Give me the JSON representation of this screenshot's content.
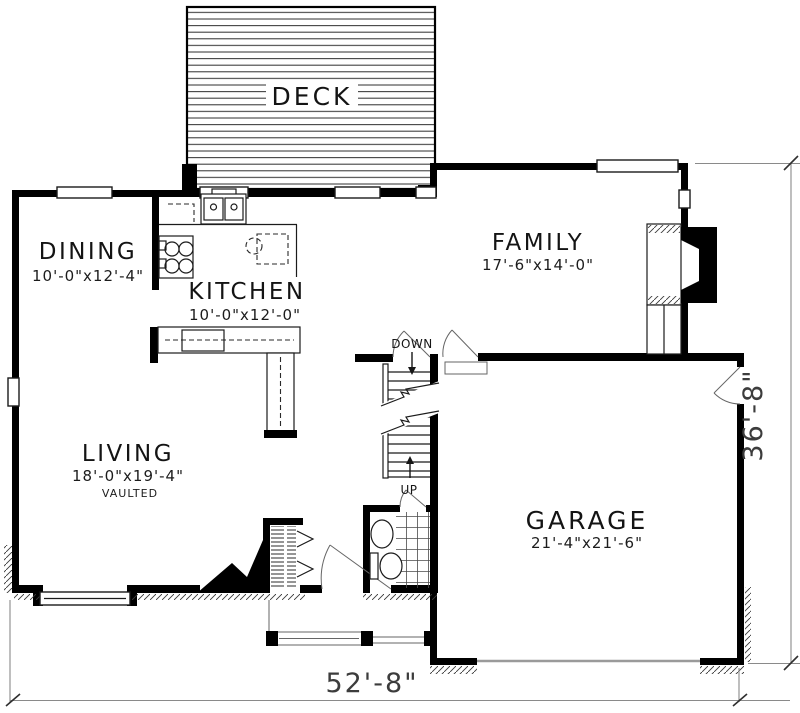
{
  "plan": {
    "rooms": {
      "deck": {
        "name": "DECK"
      },
      "dining": {
        "name": "DINING",
        "dims": "10'-0\"x12'-4\""
      },
      "kitchen": {
        "name": "KITCHEN",
        "dims": "10'-0\"x12'-0\""
      },
      "family": {
        "name": "FAMILY",
        "dims": "17'-6\"x14'-0\""
      },
      "living": {
        "name": "LIVING",
        "dims": "18'-0\"x19'-4\"",
        "note": "VAULTED"
      },
      "garage": {
        "name": "GARAGE",
        "dims": "21'-4\"x21'-6\""
      }
    },
    "stairs": {
      "down_label": "DOWN",
      "up_label": "UP"
    },
    "dimensions": {
      "overall_width": "52'-8\"",
      "overall_depth": "36'-8\""
    },
    "colors": {
      "wall": "#000000",
      "thin_line": "#1b1b1b",
      "dimension_line": "#8a8a8a"
    }
  }
}
